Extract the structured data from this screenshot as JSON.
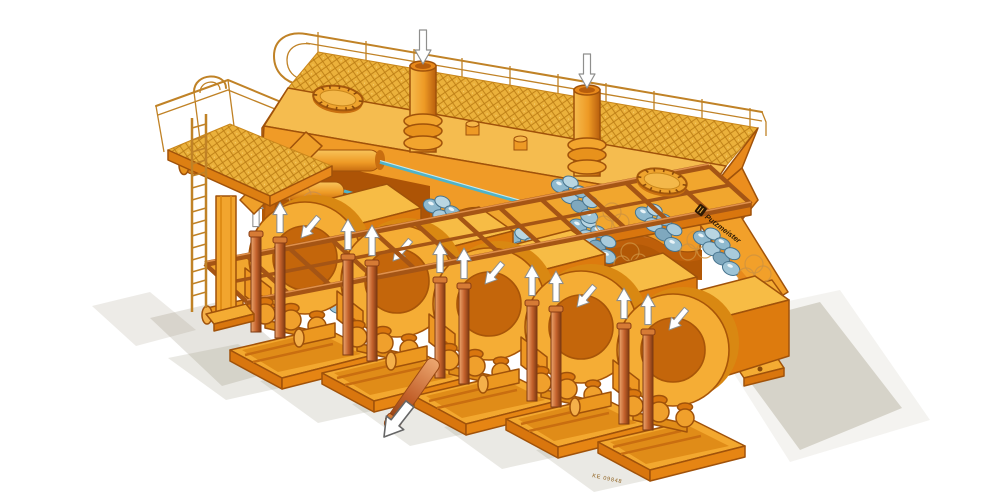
{
  "page": {
    "background": "#ffffff"
  },
  "illustration": {
    "type": "isometric-cutaway-technical-illustration",
    "subject": "five-cylinder piston pump installation with overhead tank, walkway platform and feed trough",
    "logo_text": "Putzmeister",
    "drawing_number": "KE 09848",
    "unit_count": 5,
    "origin": {
      "x": 305,
      "y": 258
    },
    "units": [
      {
        "dx": 0,
        "dy": 0
      },
      {
        "dx": 92,
        "dy": 23
      },
      {
        "dx": 184,
        "dy": 46
      },
      {
        "dx": 276,
        "dy": 69
      },
      {
        "dx": 368,
        "dy": 92
      }
    ],
    "boulder_clusters": [
      {
        "x": 308,
        "y": 276
      },
      {
        "x": 356,
        "y": 266
      },
      {
        "x": 448,
        "y": 250
      },
      {
        "x": 512,
        "y": 238
      },
      {
        "x": 578,
        "y": 226
      },
      {
        "x": 644,
        "y": 214
      },
      {
        "x": 702,
        "y": 238
      },
      {
        "x": 320,
        "y": 232
      },
      {
        "x": 432,
        "y": 206
      },
      {
        "x": 560,
        "y": 186
      }
    ],
    "flow_arrows": {
      "standpipe_down_arrows": 2,
      "candle_up_arrows_per_unit": 2,
      "arch_direction_arrows": 5,
      "discharge_outline_arrows": 1
    },
    "palette": {
      "body_light": "#f7c45c",
      "body_mid": "#f2a02a",
      "body_deep": "#e8891b",
      "outline": "#a0520a",
      "interior_dark": "#ad5406",
      "candle": "#c2602a",
      "boulder_blue": "#9ec4d6",
      "rod_teal": "#4fb3c8",
      "mesh_line": "#bc7d14",
      "railing": "#c08226",
      "shadow": "#8c8470",
      "arrow_white": "#ffffff"
    }
  }
}
